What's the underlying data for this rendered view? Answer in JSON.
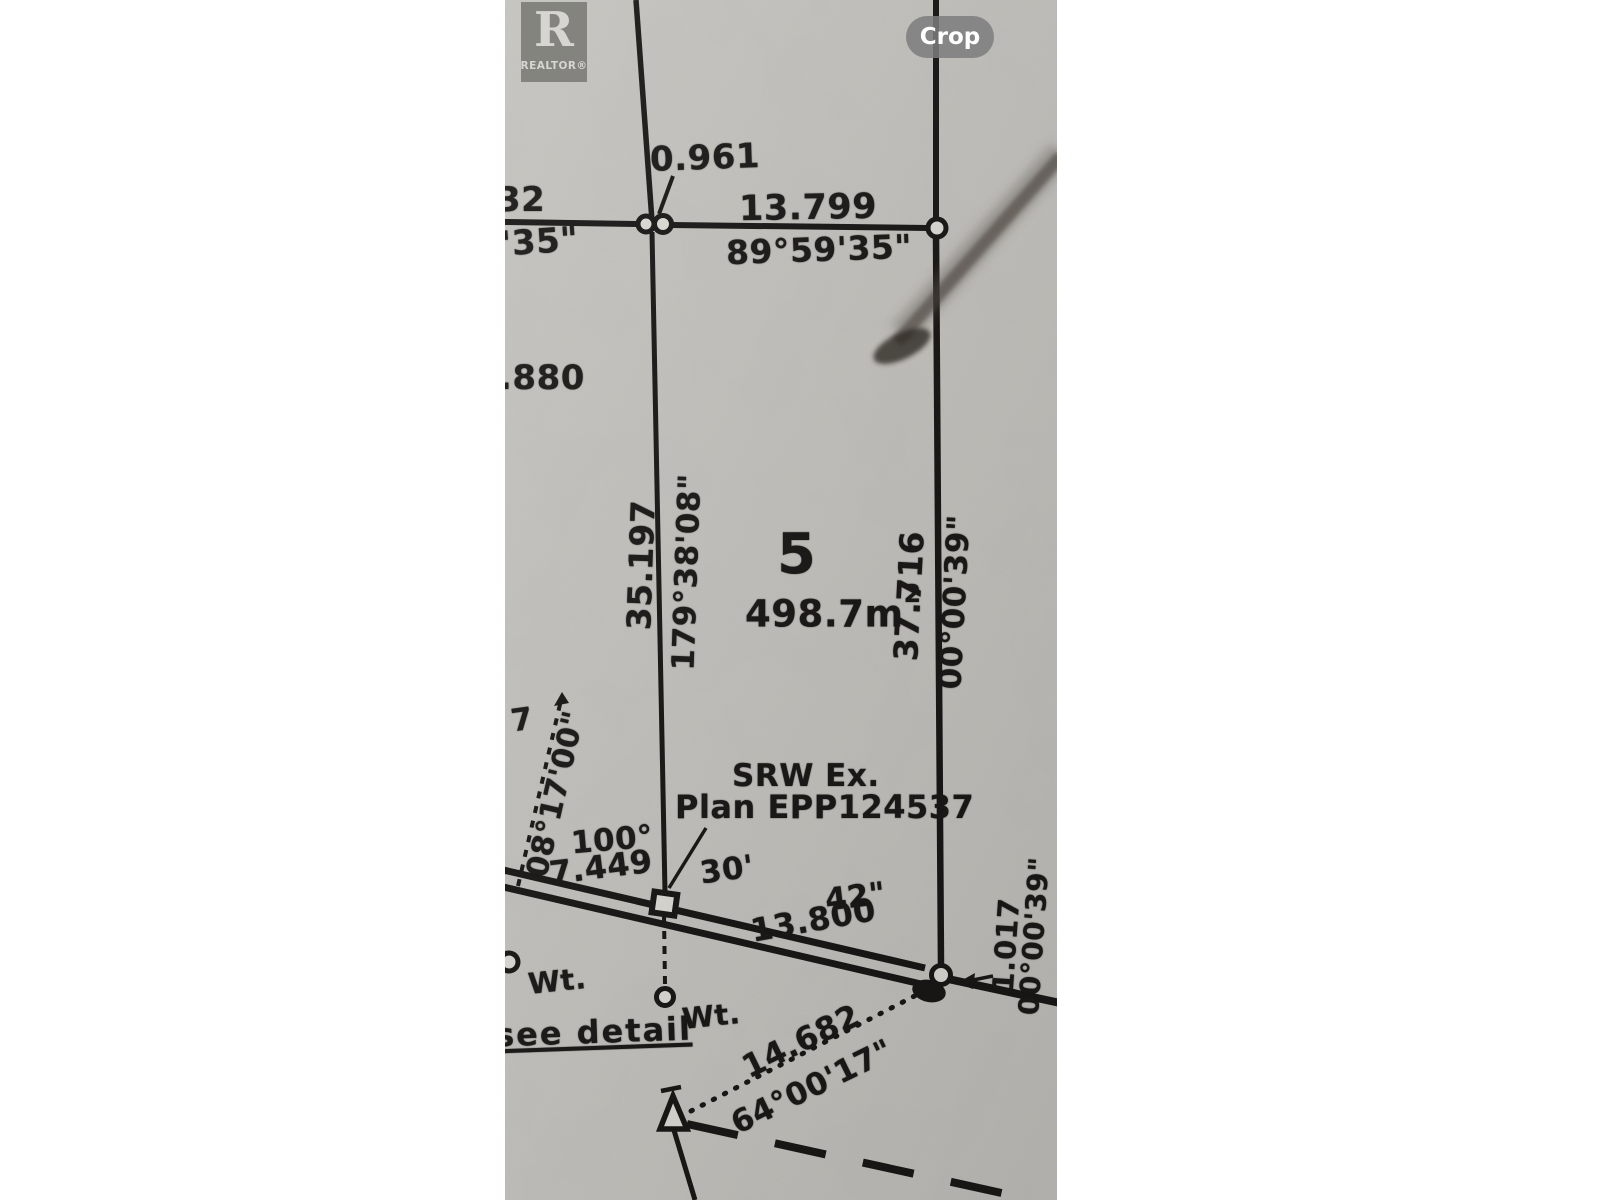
{
  "viewer": {
    "crop_button": "Crop"
  },
  "watermark": {
    "letter": "R",
    "brand": "REALTOR®"
  },
  "survey_plan": {
    "lot": {
      "number": "5",
      "area_value": "498.7m",
      "area_exponent": "2"
    },
    "top_edge": {
      "offset": "0.961",
      "distance": "13.799",
      "bearing": "89°59'35\"",
      "left_partial_distance": "32",
      "left_partial_bearing": "'35\""
    },
    "left_labels": {
      "partial_distance": ".880",
      "partial_digit": "7"
    },
    "west_boundary": {
      "distance": "35.197",
      "bearing": "179°38'08\""
    },
    "east_boundary": {
      "distance": "37.716",
      "bearing": "00°00'39\""
    },
    "srw": {
      "line1": "SRW Ex.",
      "line2": "Plan EPP124537"
    },
    "road_corner": {
      "swr_bearing": "08°17'00\"",
      "angle_deg": "100°",
      "distance": "7.449",
      "angle_min": "30'",
      "angle_sec": "42\"",
      "frontage": "13.800"
    },
    "east_corner": {
      "offset": "1.017",
      "bearing": "00°00'39\""
    },
    "monuments": {
      "wt_left": "Wt.",
      "wt_mid": "Wt.",
      "note": "see detail"
    },
    "tie_line": {
      "distance": "14.682",
      "bearing": "64°00'17\""
    }
  }
}
